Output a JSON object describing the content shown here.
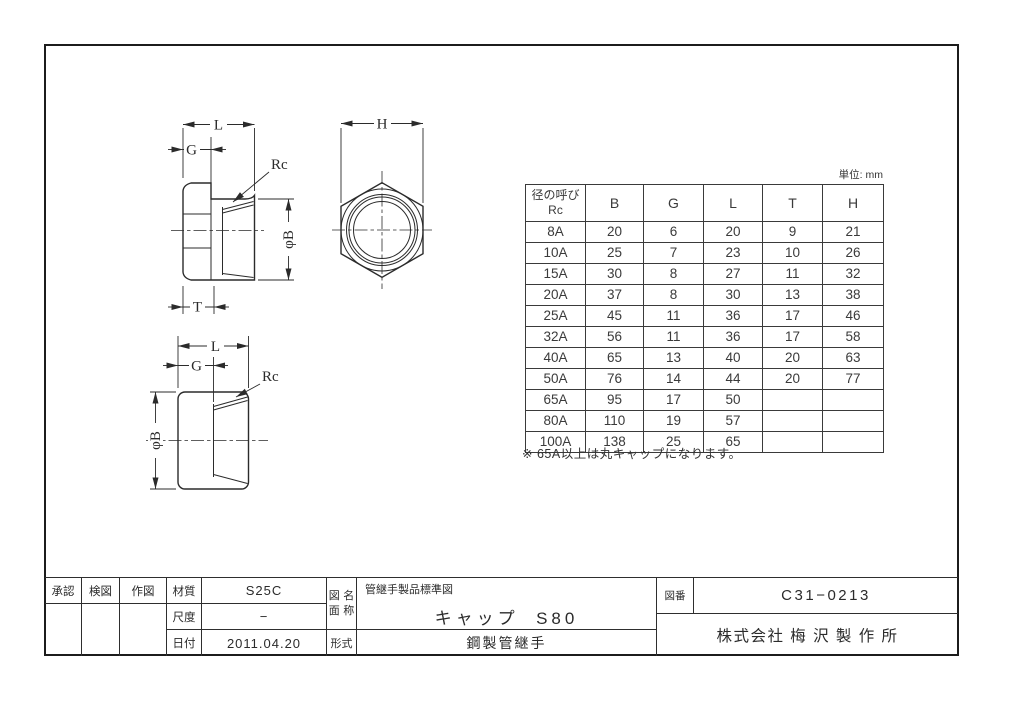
{
  "drawing": {
    "unit_label": "単位: mm",
    "note": "※ 65A以上は丸キャップになります。",
    "dim_labels": {
      "L": "L",
      "G": "G",
      "T": "T",
      "H": "H",
      "rc": "Rc",
      "phi_b": "φB"
    },
    "table": {
      "header": {
        "size_line1": "径の呼び",
        "size_line2": "Rc",
        "columns": [
          "B",
          "G",
          "L",
          "T",
          "H"
        ]
      },
      "rows": [
        [
          "8A",
          "20",
          "6",
          "20",
          "9",
          "21"
        ],
        [
          "10A",
          "25",
          "7",
          "23",
          "10",
          "26"
        ],
        [
          "15A",
          "30",
          "8",
          "27",
          "11",
          "32"
        ],
        [
          "20A",
          "37",
          "8",
          "30",
          "13",
          "38"
        ],
        [
          "25A",
          "45",
          "11",
          "36",
          "17",
          "46"
        ],
        [
          "32A",
          "56",
          "11",
          "36",
          "17",
          "58"
        ],
        [
          "40A",
          "65",
          "13",
          "40",
          "20",
          "63"
        ],
        [
          "50A",
          "76",
          "14",
          "44",
          "20",
          "77"
        ],
        [
          "65A",
          "95",
          "17",
          "50",
          "",
          ""
        ],
        [
          "80A",
          "110",
          "19",
          "57",
          "",
          ""
        ],
        [
          "100A",
          "138",
          "25",
          "65",
          "",
          ""
        ]
      ]
    },
    "title_block": {
      "approved_label": "承認",
      "checked_label": "検図",
      "drawn_label": "作図",
      "material_label": "材質",
      "material": "S25C",
      "scale_label": "尺度",
      "scale": "−",
      "date_label": "日付",
      "date": "2011.04.20",
      "name_label_line1": "図面",
      "name_label_line2": "名称",
      "name_series": "管継手製品標準図",
      "name_main": "キャップ  S80",
      "type_label": "形式",
      "type": "鋼製管継手",
      "number_label": "図番",
      "number": "C31−0213",
      "company": "株式会社 梅 沢 製 作 所"
    }
  }
}
